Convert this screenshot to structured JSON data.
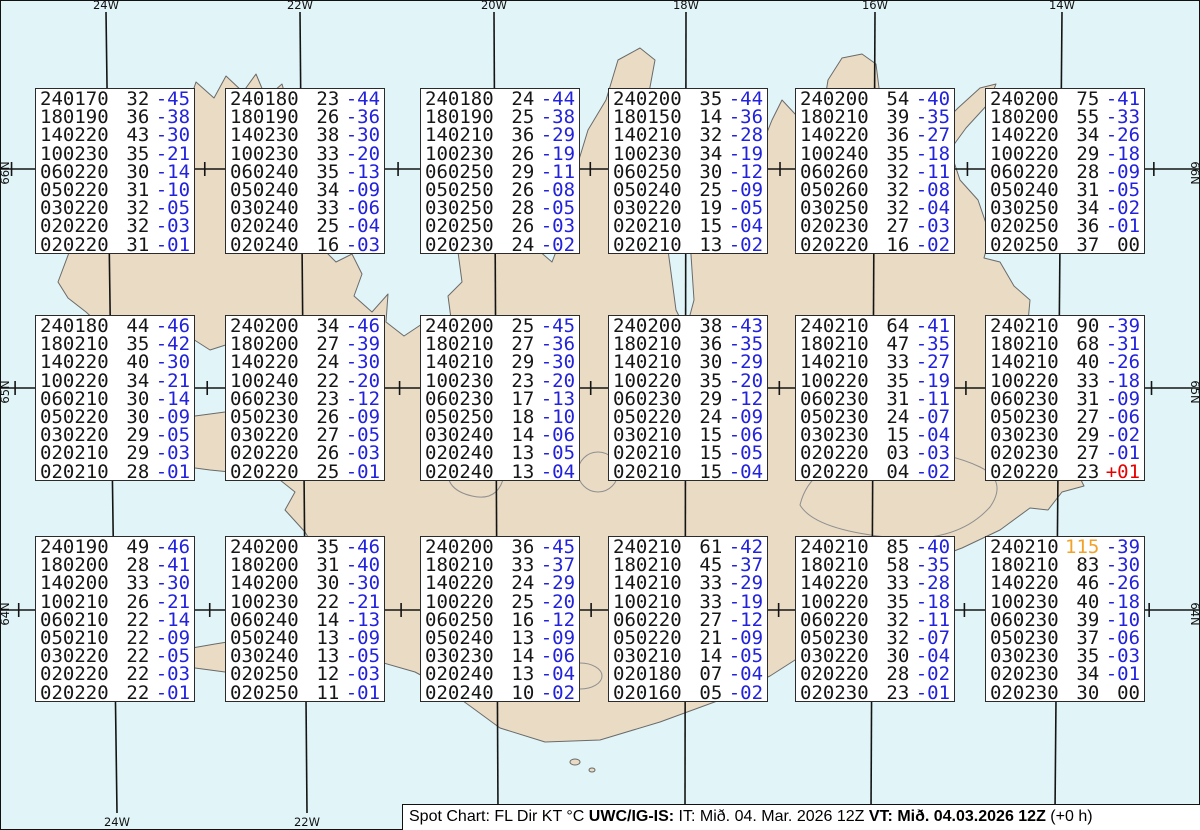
{
  "title": "Spot Chart",
  "map": {
    "ocean_color": "#e1f5f9",
    "land_color": "#e9dbc4",
    "coast_color": "#6a6a6a",
    "grid_color": "#141414",
    "meridians": [
      {
        "label": "24W",
        "x_top": 106,
        "x_bottom": 117
      },
      {
        "label": "22W",
        "x_top": 300,
        "x_bottom": 307
      },
      {
        "label": "20W",
        "x_top": 494,
        "x_bottom": 498
      },
      {
        "label": "18W",
        "x_top": 686,
        "x_bottom": 685
      },
      {
        "label": "16W",
        "x_top": 875,
        "x_bottom": 871
      },
      {
        "label": "14W",
        "x_top": 1062,
        "x_bottom": 1055
      }
    ],
    "parallels": [
      {
        "label": "66N",
        "y": 169
      },
      {
        "label": "65N",
        "y": 388
      },
      {
        "label": "64N",
        "y": 610
      }
    ]
  },
  "colors": {
    "temp_negative": "#2222dd",
    "temp_positive": "#e60000",
    "temp_zero": "#161616",
    "kt_high": "#f0a22a",
    "text": "#161616"
  },
  "legend": {
    "format": "FL Dir KT °C"
  },
  "boxes": [
    {
      "lines": [
        [
          "240170",
          "32",
          "-45"
        ],
        [
          "180190",
          "36",
          "-38"
        ],
        [
          "140220",
          "43",
          "-30"
        ],
        [
          "100230",
          "35",
          "-21"
        ],
        [
          "060220",
          "30",
          "-14"
        ],
        [
          "050220",
          "31",
          "-10"
        ],
        [
          "030220",
          "32",
          "-05"
        ],
        [
          "020220",
          "32",
          "-03"
        ],
        [
          "020220",
          "31",
          "-01"
        ]
      ]
    },
    {
      "lines": [
        [
          "240180",
          "23",
          "-44"
        ],
        [
          "180190",
          "26",
          "-36"
        ],
        [
          "140230",
          "38",
          "-30"
        ],
        [
          "100230",
          "33",
          "-20"
        ],
        [
          "060240",
          "35",
          "-13"
        ],
        [
          "050240",
          "34",
          "-09"
        ],
        [
          "030240",
          "33",
          "-06"
        ],
        [
          "020240",
          "25",
          "-04"
        ],
        [
          "020240",
          "16",
          "-03"
        ]
      ]
    },
    {
      "lines": [
        [
          "240180",
          "24",
          "-44"
        ],
        [
          "180190",
          "25",
          "-38"
        ],
        [
          "140210",
          "36",
          "-29"
        ],
        [
          "100230",
          "26",
          "-19"
        ],
        [
          "060250",
          "29",
          "-11"
        ],
        [
          "050250",
          "26",
          "-08"
        ],
        [
          "030250",
          "28",
          "-05"
        ],
        [
          "020250",
          "26",
          "-03"
        ],
        [
          "020230",
          "24",
          "-02"
        ]
      ]
    },
    {
      "lines": [
        [
          "240200",
          "35",
          "-44"
        ],
        [
          "180150",
          "14",
          "-36"
        ],
        [
          "140210",
          "32",
          "-28"
        ],
        [
          "100230",
          "34",
          "-19"
        ],
        [
          "060250",
          "30",
          "-12"
        ],
        [
          "050240",
          "25",
          "-09"
        ],
        [
          "030220",
          "19",
          "-05"
        ],
        [
          "020210",
          "15",
          "-04"
        ],
        [
          "020210",
          "13",
          "-02"
        ]
      ]
    },
    {
      "lines": [
        [
          "240200",
          "54",
          "-40"
        ],
        [
          "180210",
          "39",
          "-35"
        ],
        [
          "140220",
          "36",
          "-27"
        ],
        [
          "100240",
          "35",
          "-18"
        ],
        [
          "060260",
          "32",
          "-11"
        ],
        [
          "050260",
          "32",
          "-08"
        ],
        [
          "030250",
          "32",
          "-04"
        ],
        [
          "020230",
          "27",
          "-03"
        ],
        [
          "020220",
          "16",
          "-02"
        ]
      ]
    },
    {
      "lines": [
        [
          "240200",
          "75",
          "-41"
        ],
        [
          "180200",
          "55",
          "-33"
        ],
        [
          "140220",
          "34",
          "-26"
        ],
        [
          "100220",
          "29",
          "-18"
        ],
        [
          "060220",
          "28",
          "-09"
        ],
        [
          "050240",
          "31",
          "-05"
        ],
        [
          "030250",
          "34",
          "-02"
        ],
        [
          "020250",
          "36",
          "-01"
        ],
        [
          "020250",
          "37",
          "00"
        ]
      ]
    },
    {
      "lines": [
        [
          "240180",
          "44",
          "-46"
        ],
        [
          "180210",
          "35",
          "-42"
        ],
        [
          "140220",
          "40",
          "-30"
        ],
        [
          "100220",
          "34",
          "-21"
        ],
        [
          "060210",
          "30",
          "-14"
        ],
        [
          "050220",
          "30",
          "-09"
        ],
        [
          "030220",
          "29",
          "-05"
        ],
        [
          "020210",
          "29",
          "-03"
        ],
        [
          "020210",
          "28",
          "-01"
        ]
      ]
    },
    {
      "lines": [
        [
          "240200",
          "34",
          "-46"
        ],
        [
          "180200",
          "27",
          "-39"
        ],
        [
          "140220",
          "24",
          "-30"
        ],
        [
          "100240",
          "22",
          "-20"
        ],
        [
          "060230",
          "23",
          "-12"
        ],
        [
          "050230",
          "26",
          "-09"
        ],
        [
          "030220",
          "27",
          "-05"
        ],
        [
          "020220",
          "26",
          "-03"
        ],
        [
          "020220",
          "25",
          "-01"
        ]
      ]
    },
    {
      "lines": [
        [
          "240200",
          "25",
          "-45"
        ],
        [
          "180210",
          "27",
          "-36"
        ],
        [
          "140210",
          "29",
          "-30"
        ],
        [
          "100230",
          "23",
          "-20"
        ],
        [
          "060230",
          "17",
          "-13"
        ],
        [
          "050250",
          "18",
          "-10"
        ],
        [
          "030240",
          "14",
          "-06"
        ],
        [
          "020240",
          "13",
          "-05"
        ],
        [
          "020240",
          "13",
          "-04"
        ]
      ]
    },
    {
      "lines": [
        [
          "240200",
          "38",
          "-43"
        ],
        [
          "180210",
          "36",
          "-35"
        ],
        [
          "140210",
          "30",
          "-29"
        ],
        [
          "100220",
          "35",
          "-20"
        ],
        [
          "060230",
          "29",
          "-12"
        ],
        [
          "050220",
          "24",
          "-09"
        ],
        [
          "030210",
          "15",
          "-06"
        ],
        [
          "020210",
          "15",
          "-05"
        ],
        [
          "020210",
          "15",
          "-04"
        ]
      ]
    },
    {
      "lines": [
        [
          "240210",
          "64",
          "-41"
        ],
        [
          "180210",
          "47",
          "-35"
        ],
        [
          "140210",
          "33",
          "-27"
        ],
        [
          "100220",
          "35",
          "-19"
        ],
        [
          "060230",
          "31",
          "-11"
        ],
        [
          "050230",
          "24",
          "-07"
        ],
        [
          "030230",
          "15",
          "-04"
        ],
        [
          "020220",
          "03",
          "-03"
        ],
        [
          "020220",
          "04",
          "-02"
        ]
      ]
    },
    {
      "lines": [
        [
          "240210",
          "90",
          "-39"
        ],
        [
          "180210",
          "68",
          "-31"
        ],
        [
          "140210",
          "40",
          "-26"
        ],
        [
          "100220",
          "33",
          "-18"
        ],
        [
          "060230",
          "31",
          "-09"
        ],
        [
          "050230",
          "27",
          "-06"
        ],
        [
          "030230",
          "29",
          "-02"
        ],
        [
          "020230",
          "27",
          "-01"
        ],
        [
          "020220",
          "23",
          "+01"
        ]
      ]
    },
    {
      "lines": [
        [
          "240190",
          "49",
          "-46"
        ],
        [
          "180200",
          "28",
          "-41"
        ],
        [
          "140200",
          "33",
          "-30"
        ],
        [
          "100210",
          "26",
          "-21"
        ],
        [
          "060210",
          "22",
          "-14"
        ],
        [
          "050210",
          "22",
          "-09"
        ],
        [
          "030220",
          "22",
          "-05"
        ],
        [
          "020220",
          "22",
          "-03"
        ],
        [
          "020220",
          "22",
          "-01"
        ]
      ]
    },
    {
      "lines": [
        [
          "240200",
          "35",
          "-46"
        ],
        [
          "180200",
          "31",
          "-40"
        ],
        [
          "140200",
          "30",
          "-30"
        ],
        [
          "100230",
          "22",
          "-21"
        ],
        [
          "060240",
          "14",
          "-13"
        ],
        [
          "050240",
          "13",
          "-09"
        ],
        [
          "030240",
          "13",
          "-05"
        ],
        [
          "020250",
          "12",
          "-03"
        ],
        [
          "020250",
          "11",
          "-01"
        ]
      ]
    },
    {
      "lines": [
        [
          "240200",
          "36",
          "-45"
        ],
        [
          "180210",
          "33",
          "-37"
        ],
        [
          "140220",
          "24",
          "-29"
        ],
        [
          "100220",
          "25",
          "-20"
        ],
        [
          "060250",
          "16",
          "-12"
        ],
        [
          "050240",
          "13",
          "-09"
        ],
        [
          "030230",
          "14",
          "-06"
        ],
        [
          "020240",
          "13",
          "-04"
        ],
        [
          "020240",
          "10",
          "-02"
        ]
      ]
    },
    {
      "lines": [
        [
          "240210",
          "61",
          "-42"
        ],
        [
          "180210",
          "45",
          "-37"
        ],
        [
          "140210",
          "33",
          "-29"
        ],
        [
          "100210",
          "33",
          "-19"
        ],
        [
          "060220",
          "27",
          "-12"
        ],
        [
          "050220",
          "21",
          "-09"
        ],
        [
          "030210",
          "14",
          "-05"
        ],
        [
          "020180",
          "07",
          "-04"
        ],
        [
          "020160",
          "05",
          "-02"
        ]
      ]
    },
    {
      "lines": [
        [
          "240210",
          "85",
          "-40"
        ],
        [
          "180210",
          "58",
          "-35"
        ],
        [
          "140220",
          "33",
          "-28"
        ],
        [
          "100220",
          "35",
          "-18"
        ],
        [
          "060220",
          "32",
          "-11"
        ],
        [
          "050230",
          "32",
          "-07"
        ],
        [
          "030220",
          "30",
          "-04"
        ],
        [
          "020220",
          "28",
          "-02"
        ],
        [
          "020230",
          "23",
          "-01"
        ]
      ]
    },
    {
      "lines": [
        [
          "240210",
          "115",
          "-39"
        ],
        [
          "180210",
          "83",
          "-30"
        ],
        [
          "140220",
          "46",
          "-26"
        ],
        [
          "100230",
          "40",
          "-18"
        ],
        [
          "060230",
          "39",
          "-10"
        ],
        [
          "050230",
          "37",
          "-06"
        ],
        [
          "030230",
          "35",
          "-03"
        ],
        [
          "020230",
          "34",
          "-01"
        ],
        [
          "020230",
          "30",
          "00"
        ]
      ]
    }
  ],
  "footer": {
    "segments": [
      {
        "text": "Spot Chart: FL Dir KT °C ",
        "bold": false
      },
      {
        "text": "UWC/IG-IS:",
        "bold": true
      },
      {
        "text": " IT: Mið. 04. Mar. 2026 12Z ",
        "bold": false
      },
      {
        "text": "VT: Mið. 04.03.2026 12Z",
        "bold": true
      },
      {
        "text": " (+0 h)",
        "bold": false
      }
    ]
  }
}
